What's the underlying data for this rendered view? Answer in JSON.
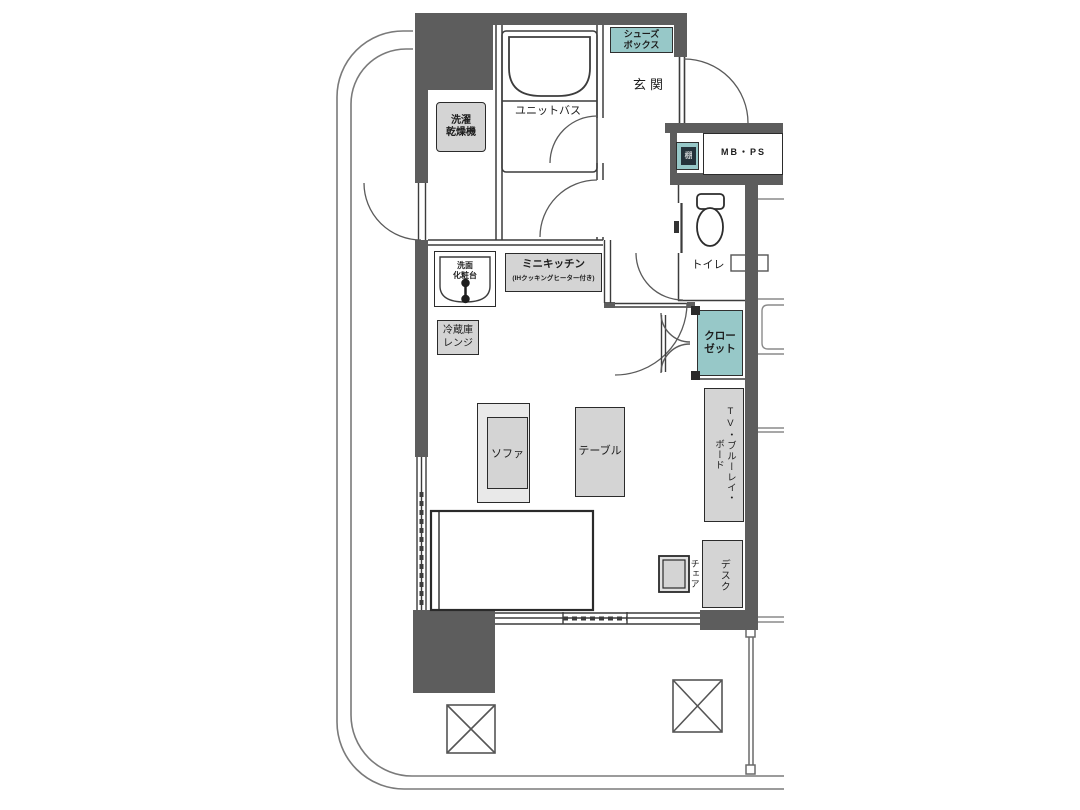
{
  "plan": {
    "type": "japanese-apartment-floorplan",
    "rooms": {
      "genkan": "玄関",
      "unit_bath": "ユニットバス",
      "toilet": "トイレ",
      "mb_ps": "MB・PS"
    },
    "fixtures": {
      "shoes_box": "シューズ\nボックス",
      "shelf": "棚",
      "washer_dryer": "洗濯\n乾燥機",
      "vanity": "洗面\n化粧台",
      "mini_kitchen": "ミニキッチン",
      "mini_kitchen_note": "(IHクッキングヒーター付き)",
      "fridge": "冷蔵庫\nレンジ",
      "closet": "クロー\nゼット"
    },
    "furniture": {
      "sofa": "ソファ",
      "table": "テーブル",
      "tv_board": "TV・ブルーレイ・\nボード",
      "chair": "チェア",
      "desk": "デスク"
    },
    "colors": {
      "wall": "#5d5d5d",
      "accent_teal": "#97c8c8",
      "furniture_gray": "#d4d4d4",
      "line": "#3c3c3c"
    }
  }
}
